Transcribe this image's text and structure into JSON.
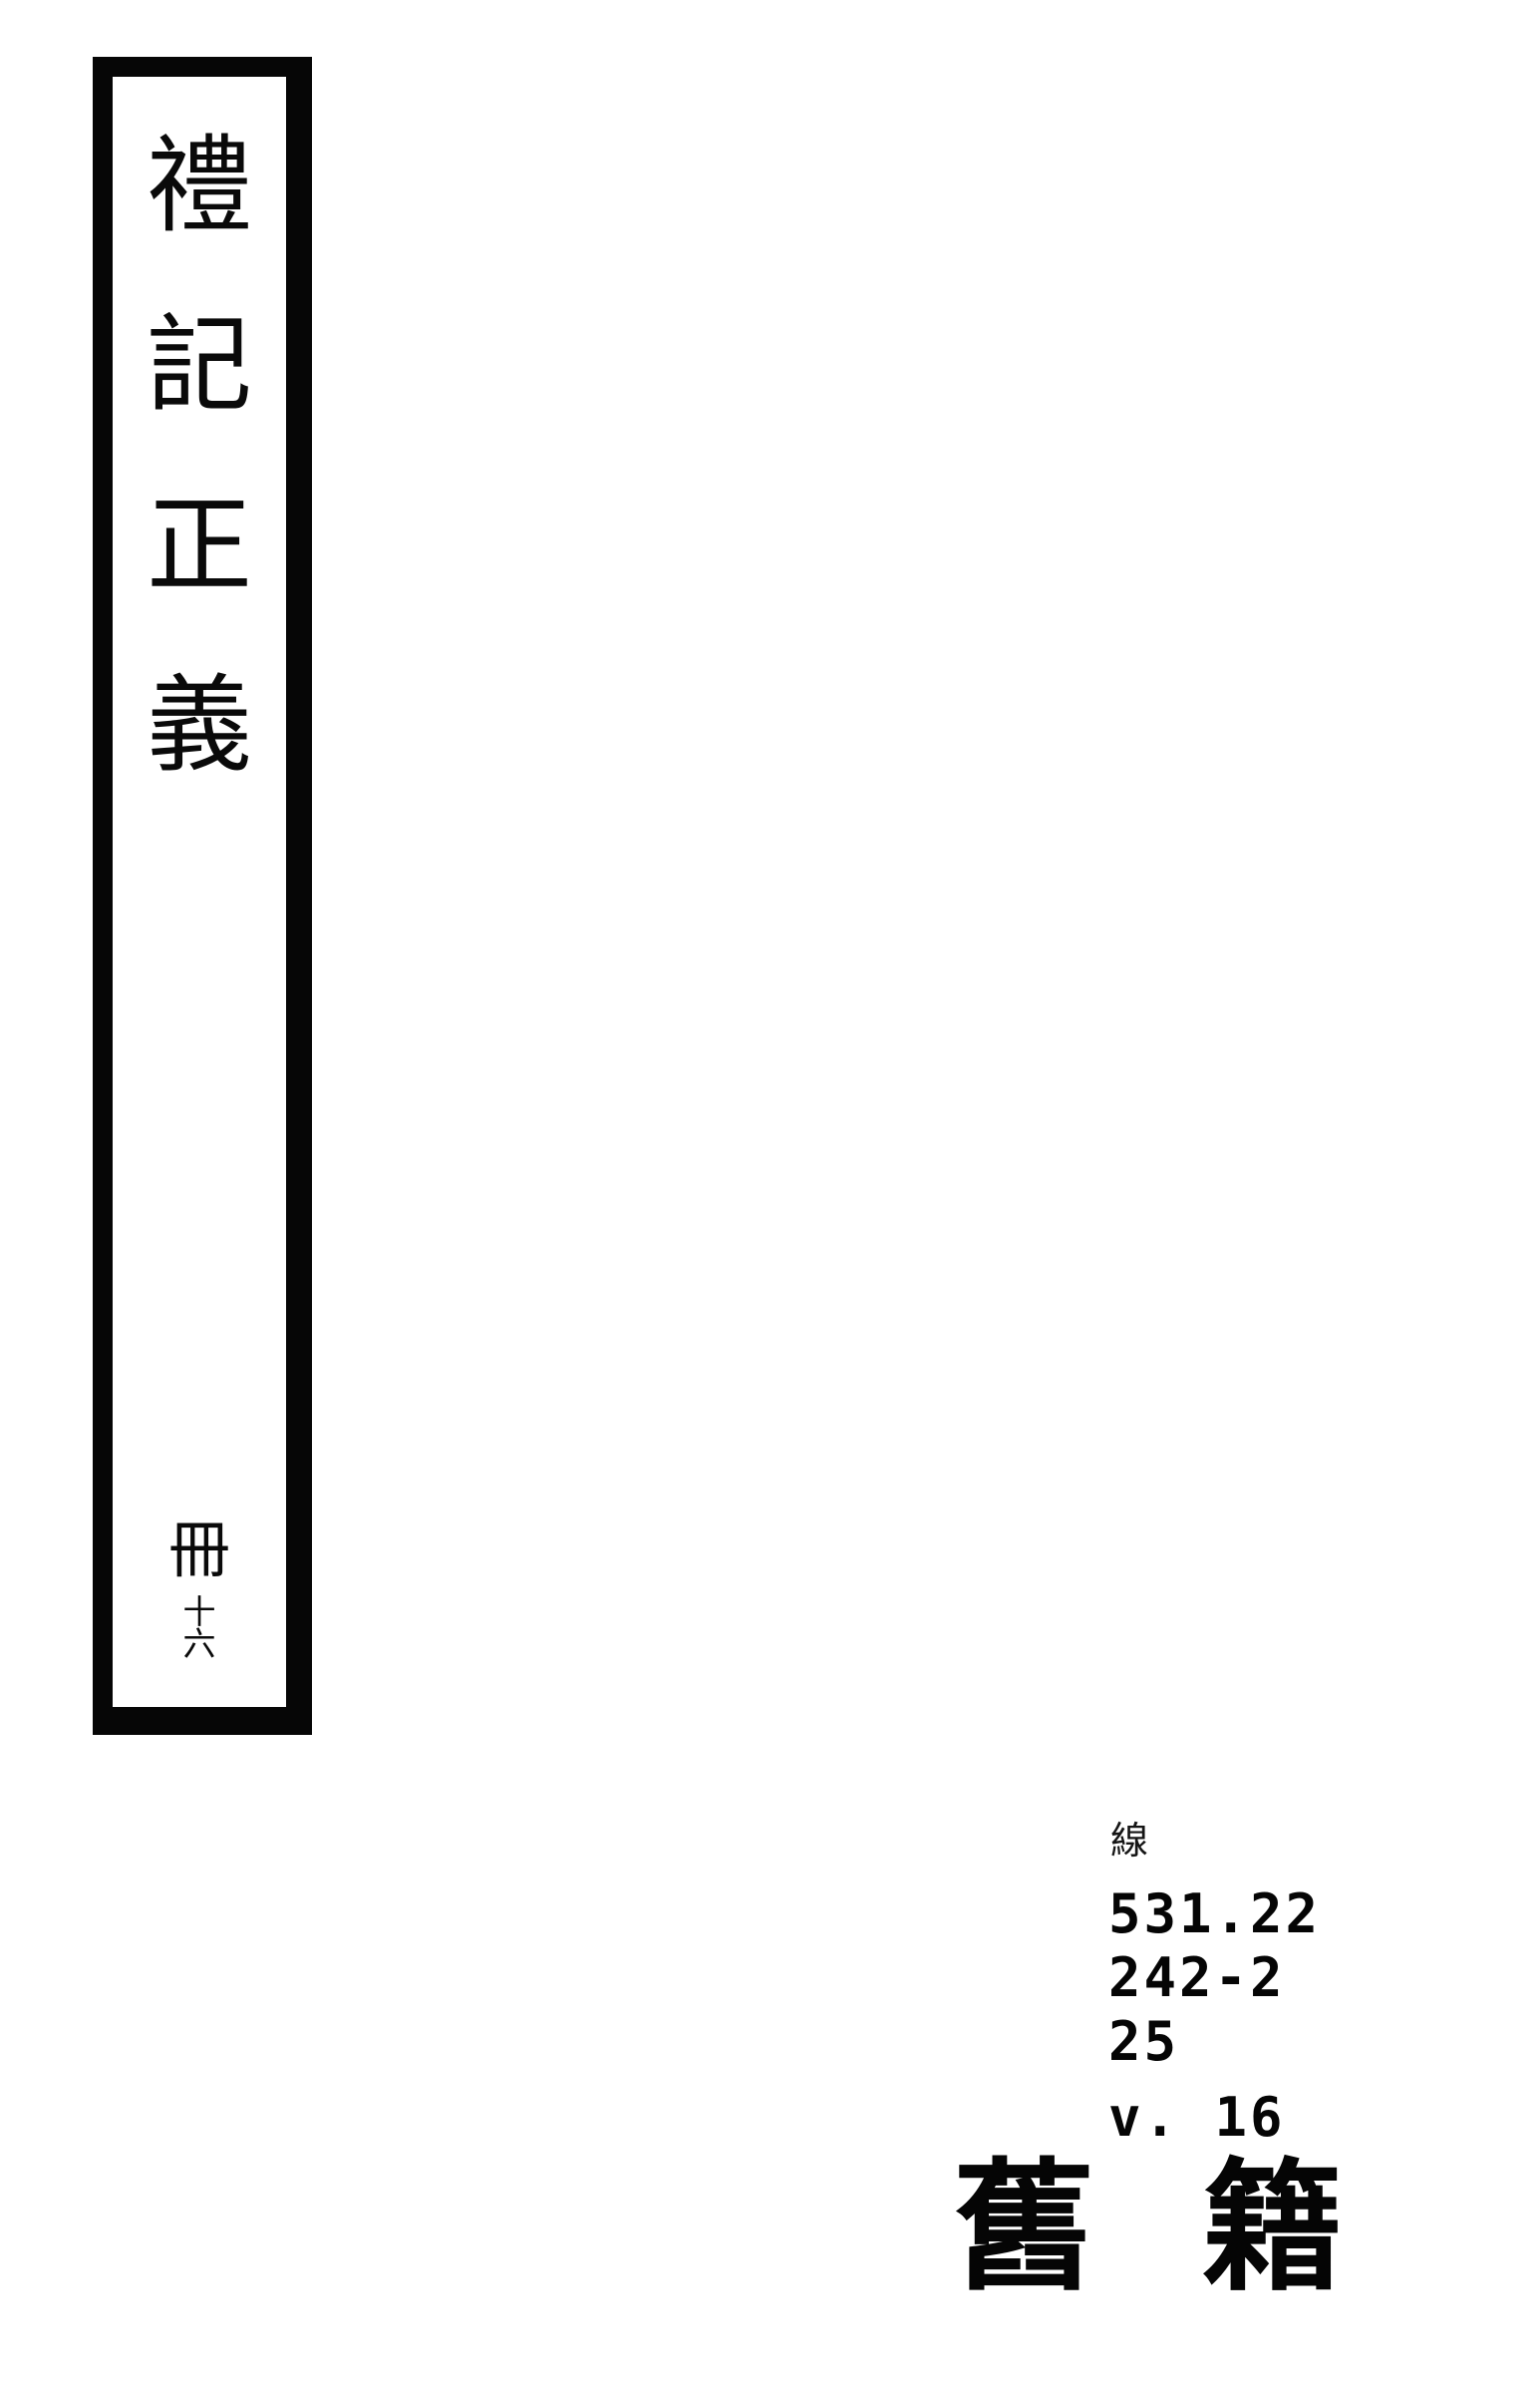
{
  "page": {
    "background_color": "#ffffff",
    "ink_color": "#000000",
    "description_kind": "scanned thread-bound book cover with title slip, call number and collection stamp"
  },
  "spine": {
    "title": "禮記正義",
    "title_chars": [
      "禮",
      "記",
      "正",
      "義"
    ],
    "volume_prefix": "冊",
    "volume_number": "十六",
    "volume_chars": [
      "冊",
      "十六"
    ]
  },
  "call_number": {
    "collection_char": "線",
    "lines": [
      "531.22",
      "242-2",
      "25",
      "v. 16"
    ]
  },
  "stamp": {
    "label": "舊籍",
    "chars": [
      "舊",
      "籍"
    ]
  }
}
